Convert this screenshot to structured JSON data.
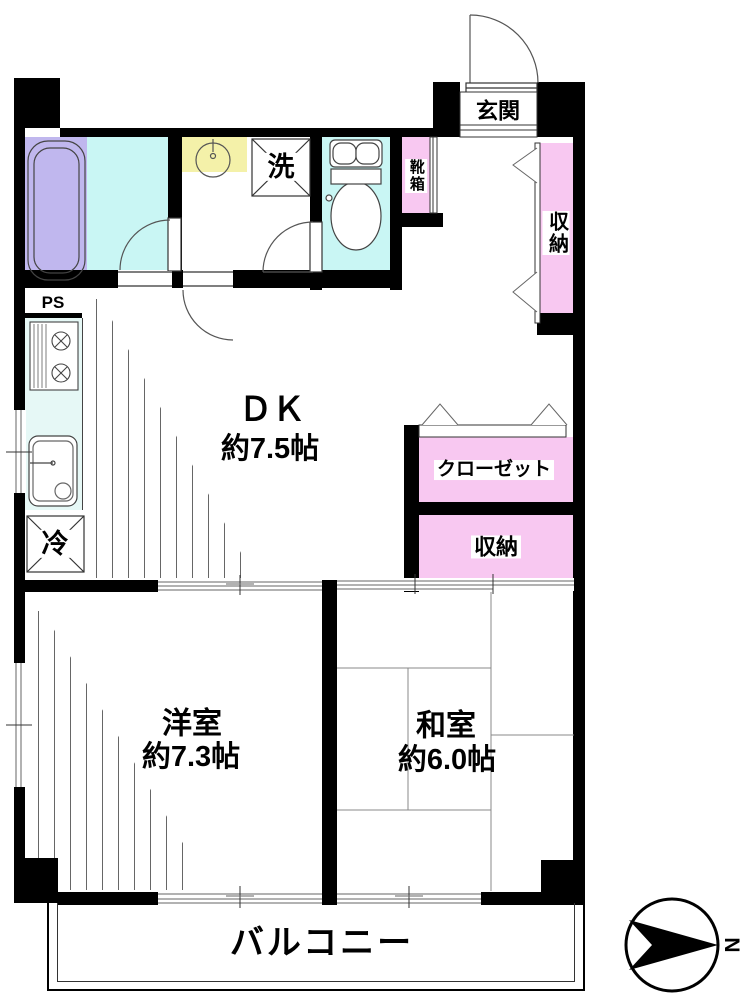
{
  "floorplan": {
    "entrance": {
      "label": "玄関"
    },
    "shoe_box": {
      "label": "靴箱"
    },
    "hall_storage": {
      "label": "収納"
    },
    "washer": {
      "label": "洗"
    },
    "pipe_space": {
      "label": "PS"
    },
    "refrigerator": {
      "label": "冷"
    },
    "dining_kitchen": {
      "name": "ＤＫ",
      "size": "約7.5帖"
    },
    "closet": {
      "label": "クローゼット"
    },
    "storage": {
      "label": "収納"
    },
    "western_room": {
      "name": "洋室",
      "size": "約7.3帖"
    },
    "japanese_room": {
      "name": "和室",
      "size": "約6.0帖"
    },
    "balcony": {
      "label": "バルコニー"
    },
    "compass": {
      "north": "N"
    }
  },
  "colors": {
    "wall": "#000000",
    "water-floor": "#c9f6f4",
    "bathtub": "#c0b7ee",
    "storage-pink": "#f8c8f1",
    "basin-yellow": "#f4f1a9",
    "counter": "#e6f8f6"
  }
}
